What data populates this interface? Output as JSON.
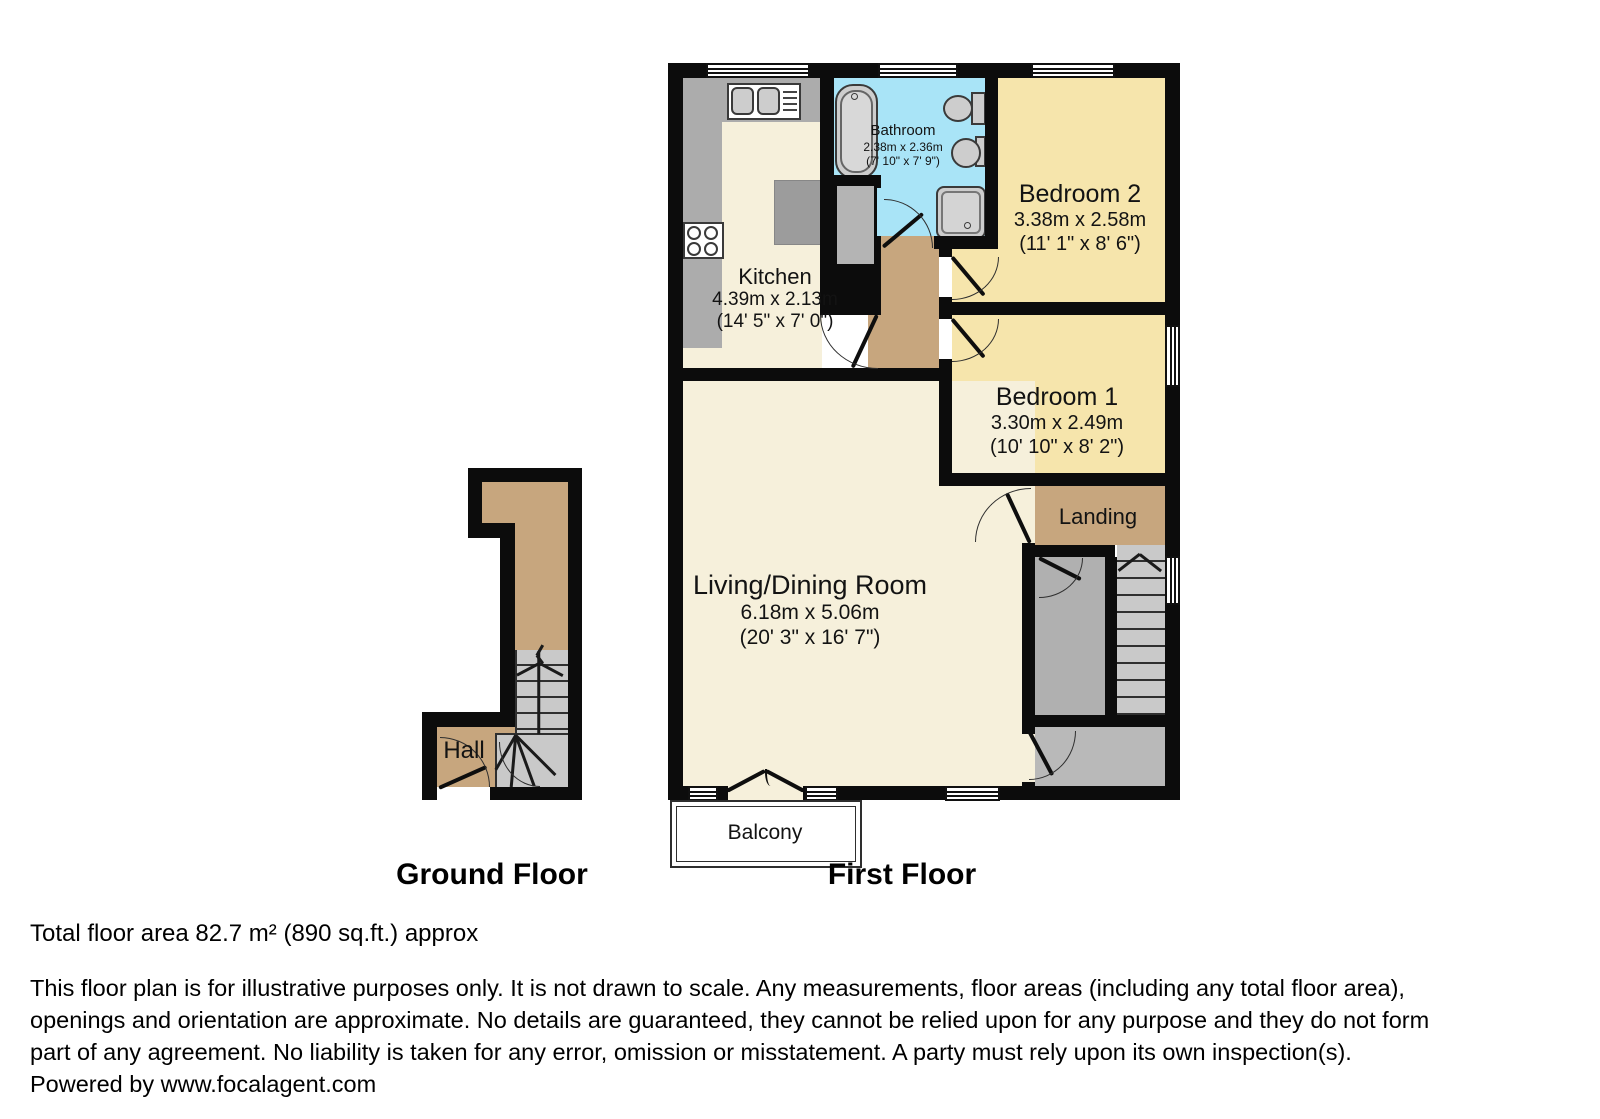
{
  "ground_floor": {
    "title": "Ground Floor",
    "hall": {
      "name": "Hall"
    }
  },
  "first_floor": {
    "title": "First Floor",
    "kitchen": {
      "name": "Kitchen",
      "metric": "4.39m x 2.13m",
      "imperial": "(14' 5\" x 7' 0\")"
    },
    "bathroom": {
      "name": "Bathroom",
      "metric": "2.38m x 2.36m",
      "imperial": "(7' 10\" x 7' 9\")"
    },
    "bedroom2": {
      "name": "Bedroom 2",
      "metric": "3.38m x 2.58m",
      "imperial": "(11' 1\" x 8' 6\")"
    },
    "bedroom1": {
      "name": "Bedroom 1",
      "metric": "3.30m x 2.49m",
      "imperial": "(10' 10\" x 8' 2\")"
    },
    "landing": {
      "name": "Landing"
    },
    "living": {
      "name": "Living/Dining Room",
      "metric": "6.18m x 5.06m",
      "imperial": "(20' 3\" x 16' 7\")"
    },
    "balcony": {
      "name": "Balcony"
    }
  },
  "footer": {
    "total_area": "Total floor area 82.7 m² (890 sq.ft.) approx",
    "disclaimer_lines": [
      "This floor plan is for illustrative purposes only. It is not drawn to scale. Any measurements, floor areas (including any total floor area),",
      "openings and orientation are approximate. No details are guaranteed, they cannot be relied upon for any purpose and they do not form",
      "part of any agreement. No liability is taken for any error, omission or misstatement. A party must rely upon its own inspection(s).",
      "Powered by www.focalagent.com"
    ]
  },
  "colors": {
    "wall": "#0c0c0c",
    "cream": "#F6F0DB",
    "bedroom_yellow": "#F6E5AC",
    "bathroom_blue": "#A9E4F7",
    "floor_tan": "#C7A67E",
    "counter_gray": "#ACACAC",
    "stair_gray": "#C9C9C9",
    "storage_gray": "#B0B0B0",
    "bottom_room_gray": "#B9B9B9",
    "cupboard_gray": "#B4B4B4",
    "appliance_gray": "#9C9C9C",
    "fixture_gray": "#CDCDCD"
  }
}
